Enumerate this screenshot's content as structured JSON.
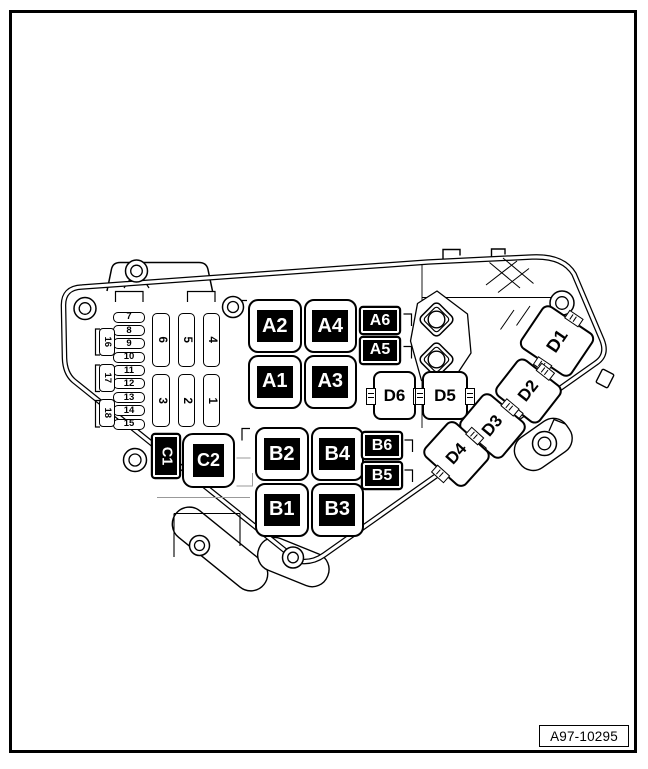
{
  "figure": {
    "code": "A97-10295"
  },
  "colors": {
    "line": "#000000",
    "background": "#ffffff",
    "label_bg": "#000000",
    "label_fg": "#ffffff",
    "detail_gray": "#999999"
  },
  "icons": {
    "bolt_hole": "double-circle",
    "stud_mount": "diamond-nut"
  },
  "panel": {
    "relay_grid_a": [
      "A2",
      "A4",
      "A1",
      "A3"
    ],
    "micro_relays_a": [
      "A6",
      "A5"
    ],
    "relay_grid_b": [
      "B2",
      "B4",
      "B1",
      "B3"
    ],
    "micro_relays_b": [
      "B6",
      "B5"
    ],
    "relay_c1": "C1",
    "relay_c2": "C2",
    "fuse_holders_row": [
      "D6",
      "D5"
    ],
    "fuse_holders_diag": [
      "D1",
      "D2",
      "D3",
      "D4"
    ],
    "mini_fuses": [
      "7",
      "8",
      "9",
      "10",
      "11",
      "12",
      "13",
      "14",
      "15"
    ],
    "edge_fuses": [
      "16",
      "17",
      "18"
    ],
    "slot_fuses_top": [
      "6",
      "5",
      "4"
    ],
    "slot_fuses_bottom": [
      "3",
      "2",
      "1"
    ]
  }
}
